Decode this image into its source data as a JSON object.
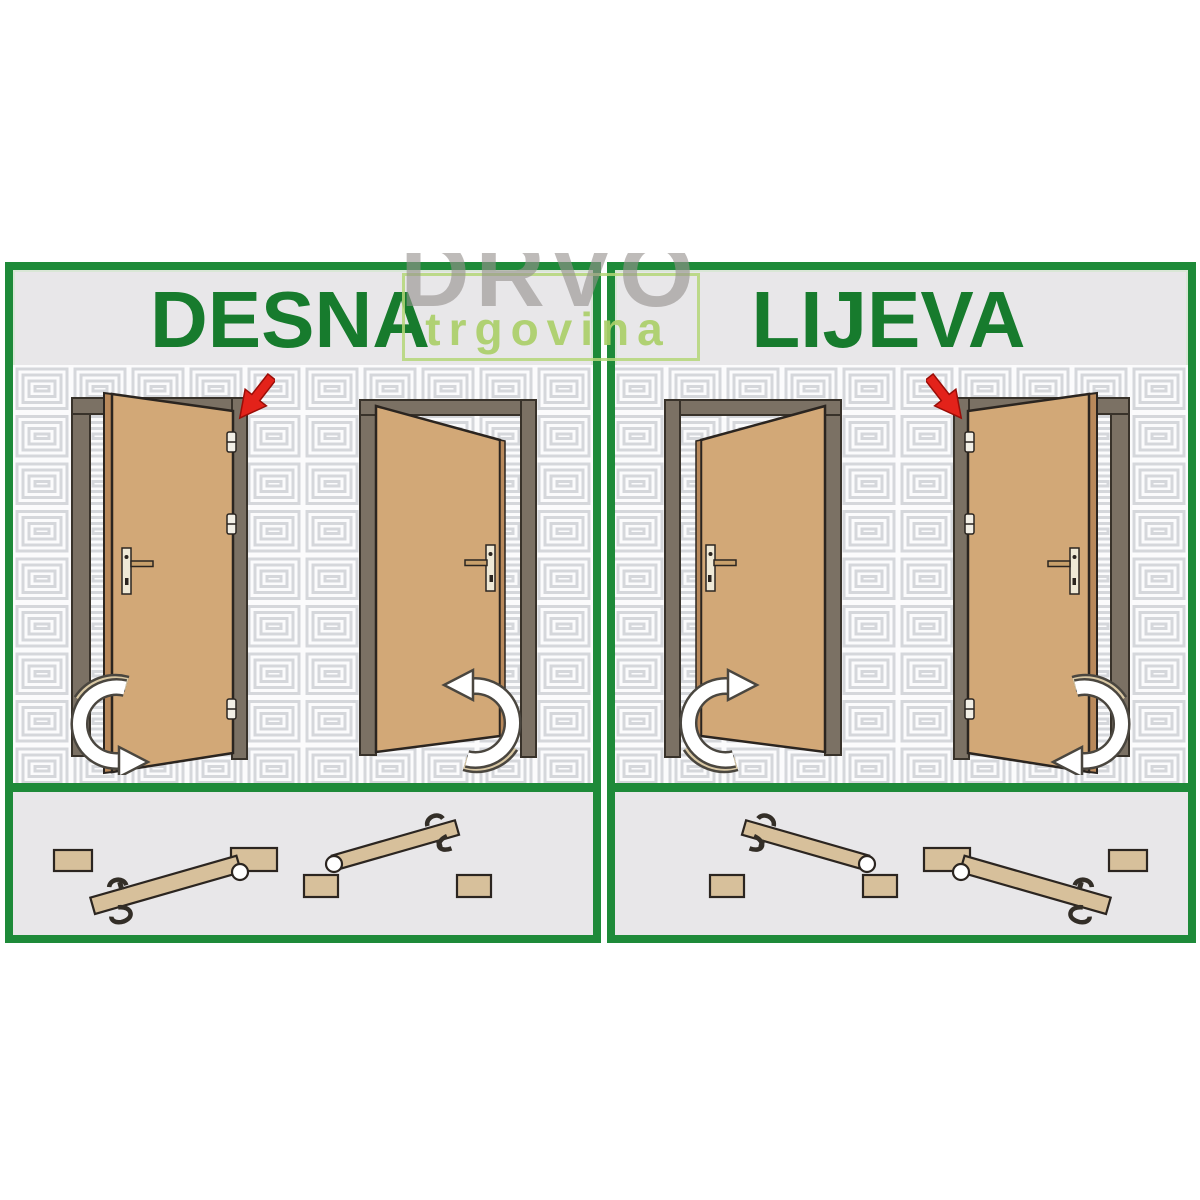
{
  "panels": [
    {
      "title": "DESNA"
    },
    {
      "title": "LIJEVA"
    }
  ],
  "watermark": {
    "line1": "DRVO",
    "line2": "trgovina"
  },
  "colors": {
    "border_green": "#1e8a39",
    "title_green": "#177b2d",
    "door_tan": "#d2a877",
    "door_edge_tan": "#b9895b",
    "frame_taupe": "#7b7164",
    "outline_dark": "#2b2520",
    "red_arrow": "#e3221a",
    "swing_arrow_white": "#ffffff",
    "swing_arrow_beige": "#d9c8a4",
    "wall_pattern_line": "#d5d7db",
    "panel_bg": "#e8e7e9",
    "topdown_wood": "#d7c09b",
    "watermark_gray": "#969290",
    "watermark_green": "#aacf68"
  },
  "icons": [
    "red-arrow-icon",
    "swing-arrow-icon",
    "hinge-icon",
    "door-handle-icon",
    "hinge-pivot-icon"
  ]
}
